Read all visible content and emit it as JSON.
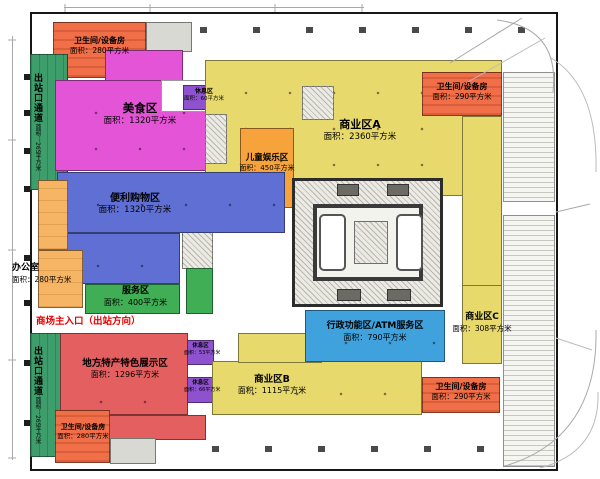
{
  "plan": {
    "entrance_label": "商场主入口（出站方向）",
    "zones": {
      "restroom_top_left": {
        "name": "卫生间/设备房",
        "area": "面积：280平方米"
      },
      "exit_corridor_top": {
        "name": "出站口通道",
        "area": "面积：265平方米"
      },
      "food_court": {
        "name": "美食区",
        "area": "面积：1320平方米"
      },
      "rest_area_top": {
        "name": "休息区",
        "area": "面积：60平方米"
      },
      "business_a": {
        "name": "商业区A",
        "area": "面积：2360平方米"
      },
      "restroom_top_right": {
        "name": "卫生间/设备房",
        "area": "面积：290平方米"
      },
      "kids_zone": {
        "name": "儿童娱乐区",
        "area": "面积：450平方米"
      },
      "convenience": {
        "name": "便利购物区",
        "area": "面积：1320平方米"
      },
      "office": {
        "name": "办公室",
        "area": "面积：280平方米"
      },
      "service": {
        "name": "服务区",
        "area": "面积：400平方米"
      },
      "specialty": {
        "name": "地方特产特色展示区",
        "area": "面积：1296平方米"
      },
      "rest_area_mid": {
        "name": "休息区",
        "area": "面积：53平方米"
      },
      "rest_area_low": {
        "name": "休息区",
        "area": "面积：66平方米"
      },
      "business_b": {
        "name": "商业区B",
        "area": "面积：1115平方米"
      },
      "admin_atm": {
        "name": "行政功能区/ATM服务区",
        "area": "面积：790平方米"
      },
      "business_c": {
        "name": "商业区C",
        "area": "面积：308平方米"
      },
      "restroom_bottom_right": {
        "name": "卫生间/设备房",
        "area": "面积：290平方米"
      },
      "restroom_bottom_left": {
        "name": "卫生间/设备房",
        "area": "面积：280平方米"
      },
      "exit_corridor_bottom": {
        "name": "出站口通道",
        "area": "面积：265平方米"
      }
    },
    "colors": {
      "food_court": "#e355d6",
      "business": "#e7d96b",
      "kids": "#f6a33b",
      "restroom": "#f06e48",
      "convenience": "#5f6fd4",
      "admin_atm": "#3fa2dc",
      "service": "#3fae54",
      "exit_corridor": "#3e9e6b",
      "specialty": "#e45f5f",
      "rest_area": "#8f52cf",
      "office": "#f6b565",
      "entrance_text": "#e60000"
    }
  }
}
